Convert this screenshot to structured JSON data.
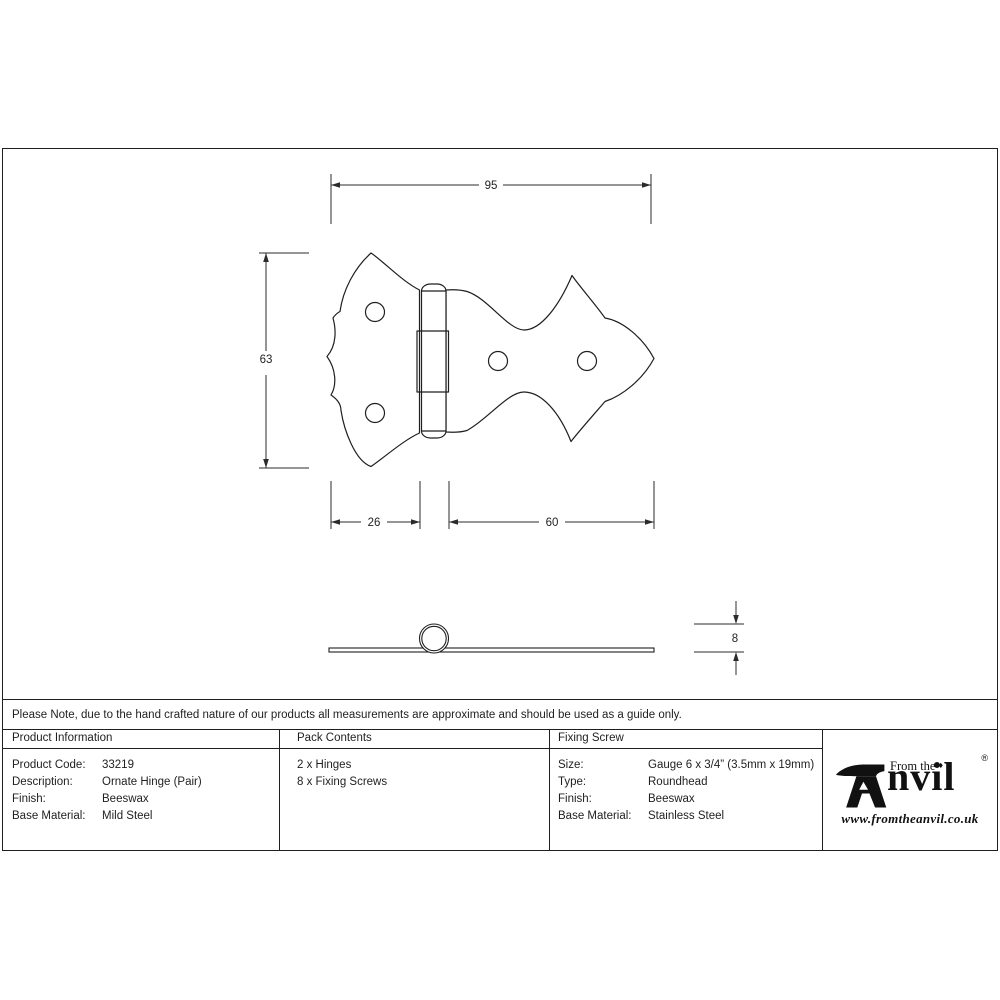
{
  "note": "Please Note, due to the hand crafted nature of our products all measurements are approximate and should be used as a guide only.",
  "drawing": {
    "dims": {
      "overall_width": "95",
      "overall_height": "63",
      "left_leaf_width": "26",
      "right_leaf_width": "60",
      "knuckle_height": "8"
    }
  },
  "table": {
    "product_information": {
      "header": "Product Information",
      "rows": [
        {
          "label": "Product Code:",
          "value": "33219"
        },
        {
          "label": "Description:",
          "value": "Ornate Hinge (Pair)"
        },
        {
          "label": "Finish:",
          "value": "Beeswax"
        },
        {
          "label": "Base Material:",
          "value": "Mild Steel"
        }
      ]
    },
    "pack_contents": {
      "header": "Pack Contents",
      "items": [
        "2 x Hinges",
        "8 x Fixing Screws"
      ]
    },
    "fixing_screw": {
      "header": "Fixing Screw",
      "rows": [
        {
          "label": "Size:",
          "value": "Gauge 6 x 3/4” (3.5mm x 19mm)"
        },
        {
          "label": "Type:",
          "value": "Roundhead"
        },
        {
          "label": "Finish:",
          "value": "Beeswax"
        },
        {
          "label": "Base Material:",
          "value": "Stainless Steel"
        }
      ]
    }
  },
  "logo": {
    "prefix": "From the",
    "diamond": "♦",
    "name_rest": "nvil",
    "registered": "®",
    "website": "www.fromtheanvil.co.uk"
  },
  "colors": {
    "line": "#1f1f1f",
    "background": "#ffffff"
  }
}
